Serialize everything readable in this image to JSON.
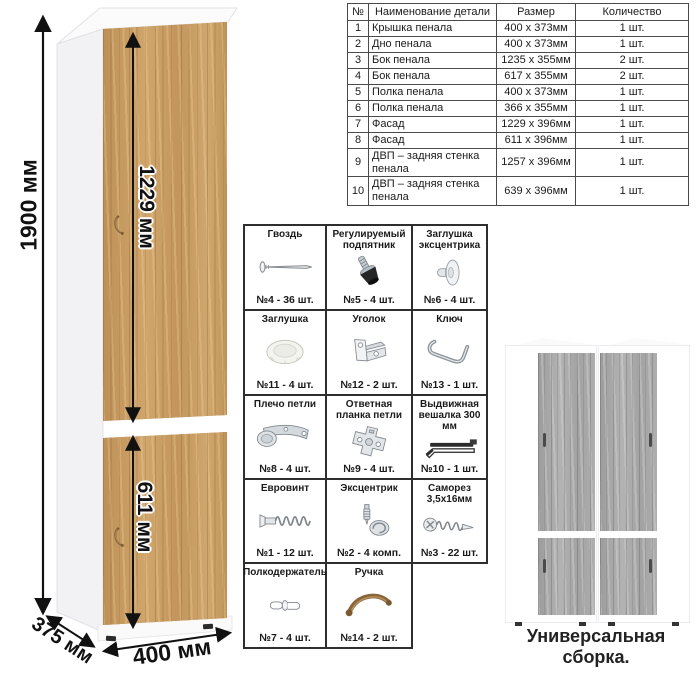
{
  "cabinet": {
    "dimensions": {
      "height": "1900 мм",
      "upper_door_height": "1229 мм",
      "lower_door_height": "611 мм",
      "depth": "375 мм",
      "width": "400 мм"
    }
  },
  "parts_table": {
    "headers": [
      "№",
      "Наименование детали",
      "Размер",
      "Количество"
    ],
    "rows": [
      [
        "1",
        "Крышка пенала",
        "400 х 373мм",
        "1 шт."
      ],
      [
        "2",
        "Дно пенала",
        "400 х 373мм",
        "1 шт."
      ],
      [
        "3",
        "Бок пенала",
        "1235 х 355мм",
        "2 шт."
      ],
      [
        "4",
        "Бок пенала",
        "617 х 355мм",
        "2 шт."
      ],
      [
        "5",
        "Полка пенала",
        "400 х 373мм",
        "1 шт."
      ],
      [
        "6",
        "Полка пенала",
        "366 х 355мм",
        "1 шт."
      ],
      [
        "7",
        "Фасад",
        "1229 х 396мм",
        "1 шт."
      ],
      [
        "8",
        "Фасад",
        "611 х 396мм",
        "1 шт."
      ],
      [
        "9",
        "ДВП – задняя стенка пенала",
        "1257 х 396мм",
        "1 шт."
      ],
      [
        "10",
        "ДВП – задняя стенка пенала",
        "639 х 396мм",
        "1 шт."
      ]
    ]
  },
  "hardware": [
    {
      "name": "Гвоздь",
      "qty": "№4 - 36 шт.",
      "icon": "nail-icon"
    },
    {
      "name": "Регулируемый подпятник",
      "qty": "№5 - 4 шт.",
      "icon": "foot-icon"
    },
    {
      "name": "Заглушка эксцентрика",
      "qty": "№6 - 4 шт.",
      "icon": "cam-cover-icon"
    },
    {
      "name": "Заглушка",
      "qty": "№11 - 4 шт.",
      "icon": "cap-icon"
    },
    {
      "name": "Уголок",
      "qty": "№12 - 2 шт.",
      "icon": "bracket-icon"
    },
    {
      "name": "Ключ",
      "qty": "№13 - 1 шт.",
      "icon": "key-icon"
    },
    {
      "name": "Плечо петли",
      "qty": "№8 - 4 шт.",
      "icon": "hinge-icon"
    },
    {
      "name": "Ответная планка петли",
      "qty": "№9 - 4 шт.",
      "icon": "plate-icon"
    },
    {
      "name": "Выдвижная вешалка 300 мм",
      "qty": "№10 - 1 шт.",
      "icon": "hanger-icon"
    },
    {
      "name": "Евровинт",
      "qty": "№1 - 12 шт.",
      "icon": "euro-screw-icon"
    },
    {
      "name": "Эксцентрик",
      "qty": "№2 - 4 комп.",
      "icon": "cam-icon"
    },
    {
      "name": "Саморез 3,5х16мм",
      "qty": "№3 - 22 шт.",
      "icon": "screw-icon"
    },
    {
      "name": "Полкодержатель",
      "qty": "№7 - 4 шт.",
      "icon": "pin-icon"
    },
    {
      "name": "Ручка",
      "qty": "№14 - 2 шт.",
      "icon": "handle-icon"
    }
  ],
  "caption": "Универсальная сборка.",
  "colors": {
    "oak_wood": "#c69b63",
    "gray_wood": "#a9a9a9",
    "handle_bronze": "#8a663a",
    "dimension_line": "#111111"
  }
}
